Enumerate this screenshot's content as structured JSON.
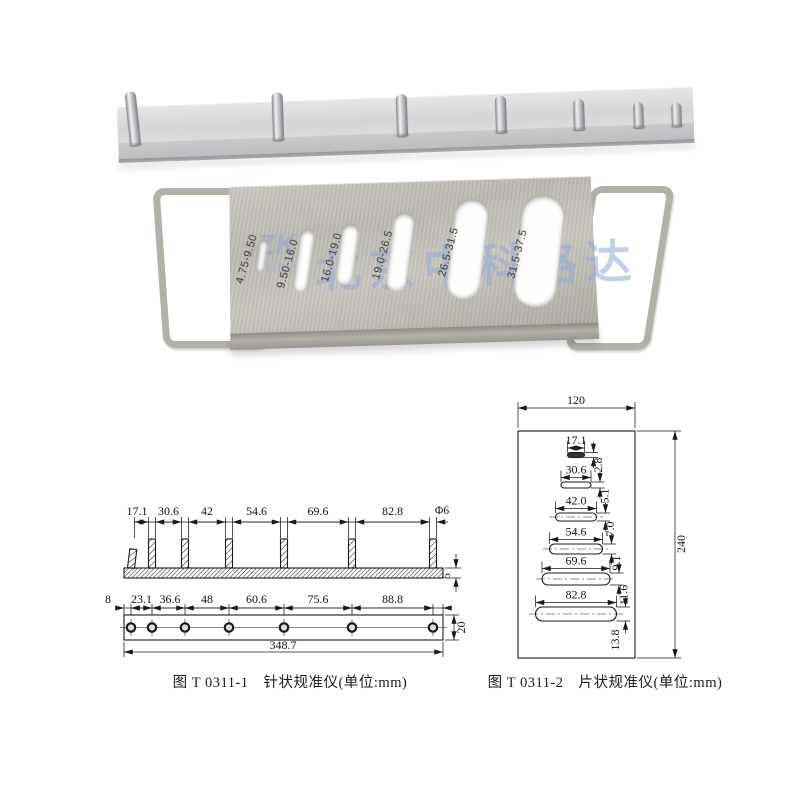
{
  "photo_slot_gauge": {
    "slot_labels": [
      "4.75-9.50",
      "9.50-16.0",
      "16.0-19.0",
      "19.0-26.5",
      "26.5-31.5",
      "31.5-37.5"
    ],
    "watermark": "北京中科路达",
    "logo_main": "ZK",
    "logo_sub": "中科路达"
  },
  "figure1": {
    "caption": "图 T 0311-1　针状规准仪(单位:mm)",
    "top_dims": [
      "17.1",
      "30.6",
      "42",
      "54.6",
      "69.6",
      "82.8"
    ],
    "pin_diameter": "Φ6",
    "bar_thickness": "5",
    "bottom_dims": [
      "8",
      "23.1",
      "36.6",
      "48",
      "60.6",
      "75.6",
      "88.8"
    ],
    "bar_width": "20",
    "total_length": "348.7"
  },
  "figure2": {
    "caption": "图 T 0311-2　片状规准仪(单位:mm)",
    "plate_width": "120",
    "plate_height": "240",
    "slot_widths": [
      "17.1",
      "30.6",
      "42.0",
      "54.6",
      "69.6",
      "82.8"
    ],
    "slot_heights": [
      "2.8",
      "5.1",
      "7.0",
      "9.1",
      "11.6",
      "13.8"
    ]
  }
}
